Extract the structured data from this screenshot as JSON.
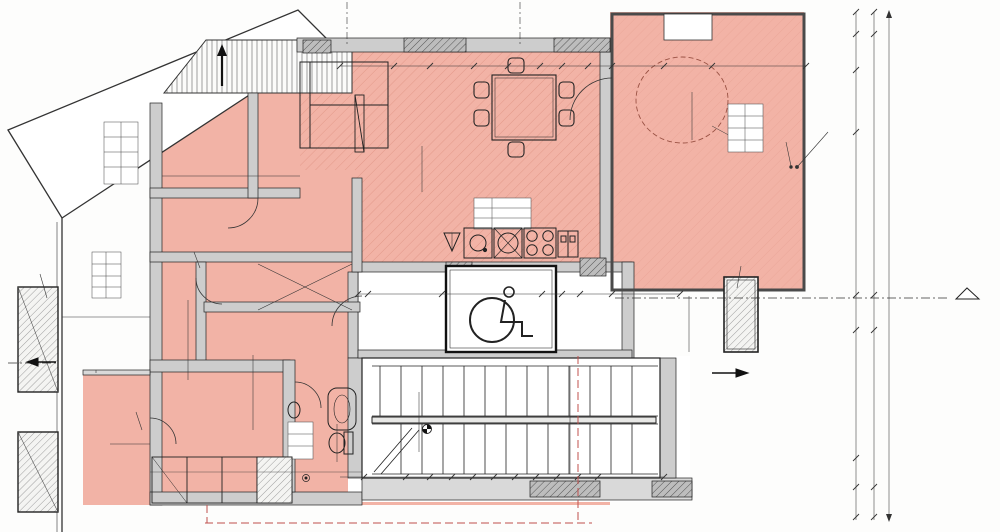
{
  "drawing": {
    "type": "architectural floor plan (attic storey)",
    "language": "Bulgarian",
    "colors": {
      "floor": "#f2b3a6",
      "wall": "#cdcdcd",
      "line": "#222222",
      "red_line": "#c0504d"
    }
  },
  "labels": [
    {
      "name": "dim-label",
      "t": "ВГ 9",
      "x": 190,
      "y": 20,
      "s": 4.5
    },
    {
      "name": "dim-label",
      "t": "ВГ 10 15",
      "x": 466,
      "y": 24,
      "s": 4.5
    },
    {
      "name": "opening-size",
      "t": "140/200",
      "x": 357,
      "y": 28,
      "r": -90,
      "s": 4.5
    },
    {
      "name": "opening-size",
      "t": "140/200",
      "x": 530,
      "y": 28,
      "r": -90,
      "s": 4.5
    },
    {
      "name": "angle-label",
      "t": "45°",
      "x": 489,
      "y": 13,
      "r": -90,
      "s": 5
    },
    {
      "name": "dim-label",
      "t": "210",
      "x": 240,
      "y": 57,
      "s": 6
    },
    {
      "name": "dim-label",
      "t": "274.5",
      "x": 254,
      "y": 80,
      "s": 6
    },
    {
      "name": "dim-label",
      "t": "100",
      "x": 205,
      "y": 90,
      "s": 5
    },
    {
      "name": "dim-label",
      "t": "154",
      "x": 247,
      "y": 91,
      "s": 5
    },
    {
      "name": "dim-label",
      "t": "25",
      "x": 296,
      "y": 66,
      "s": 4.5
    },
    {
      "name": "dim-label",
      "t": "10.5",
      "x": 312,
      "y": 81,
      "s": 4.5
    },
    {
      "name": "dim-label",
      "t": "210",
      "x": 367,
      "y": 63,
      "s": 6
    },
    {
      "name": "dim-label",
      "t": "133",
      "x": 452,
      "y": 66,
      "s": 6
    },
    {
      "name": "dim-label",
      "t": "140",
      "x": 523,
      "y": 66,
      "s": 6,
      "bg": "#ffffff"
    },
    {
      "name": "dim-label",
      "t": "78",
      "x": 574,
      "y": 68,
      "s": 6
    },
    {
      "name": "dim-label",
      "t": "10",
      "x": 617,
      "y": 61,
      "s": 4.5
    },
    {
      "name": "dim-label",
      "t": "193",
      "x": 639,
      "y": 67,
      "s": 6
    },
    {
      "name": "dim-label",
      "t": "194",
      "x": 757,
      "y": 67,
      "s": 6
    },
    {
      "name": "building-line-label",
      "t": "ЛИНИЯ НА ЗАСТРОЯВАНЕ",
      "x": 537,
      "y": 159,
      "s": 4.3,
      "c": "#c0504d",
      "bg": "#fdf0ec"
    },
    {
      "name": "dim-label",
      "t": "#150",
      "x": 686,
      "y": 88,
      "r": -35,
      "s": 5.5,
      "c": "#8a4a3a"
    },
    {
      "name": "dim-label",
      "t": "347",
      "x": 693,
      "y": 116,
      "r": -78,
      "s": 5.5
    },
    {
      "name": "note",
      "t": "Архитектурен елемент \"А\" съгласно\nчл. 93, ал. 2 от НПНОИВТ - 7.06 м2",
      "x": 836,
      "y": 103,
      "r": -90,
      "s": 4.4
    },
    {
      "name": "note",
      "t": "Ажурен парапет\nН = 1.05м\nот горна под",
      "x": 786,
      "y": 116,
      "r": -90,
      "s": 4.4
    },
    {
      "name": "dim-label",
      "t": "61",
      "x": 856,
      "y": 23,
      "r": -90
    },
    {
      "name": "dim-label",
      "t": "58",
      "x": 856,
      "y": 52,
      "r": -90
    },
    {
      "name": "dim-label",
      "t": "154",
      "x": 856,
      "y": 101,
      "r": -90
    },
    {
      "name": "dim-label",
      "t": "277",
      "x": 856,
      "y": 211,
      "r": -90
    },
    {
      "name": "dim-label",
      "t": "135",
      "x": 856,
      "y": 312,
      "r": -90
    },
    {
      "name": "dim-label",
      "t": "188",
      "x": 856,
      "y": 392,
      "r": -90
    },
    {
      "name": "dim-label",
      "t": "132",
      "x": 856,
      "y": 473,
      "r": -90
    },
    {
      "name": "dim-label",
      "t": "28",
      "x": 856,
      "y": 512,
      "r": -90
    },
    {
      "name": "dim-label",
      "t": "61",
      "x": 874,
      "y": 20,
      "r": -90
    },
    {
      "name": "dim-label",
      "t": "489",
      "x": 874,
      "y": 158,
      "r": -90
    },
    {
      "name": "dim-label",
      "t": "135",
      "x": 874,
      "y": 310,
      "r": -90
    },
    {
      "name": "dim-label",
      "t": "320",
      "x": 874,
      "y": 430,
      "r": -90
    },
    {
      "name": "dim-label",
      "t": "28",
      "x": 874,
      "y": 513,
      "r": -90
    },
    {
      "name": "dim-label",
      "t": "1033",
      "x": 890,
      "y": 264,
      "r": -90
    },
    {
      "name": "section-letter",
      "t": "Г",
      "x": 967,
      "y": 309,
      "s": 9
    },
    {
      "name": "window-label",
      "t": "Velux VIU",
      "x": 741,
      "y": 251,
      "r": -75,
      "s": 4.4
    },
    {
      "name": "dim-label",
      "t": "449",
      "x": 689,
      "y": 322,
      "r": -90
    },
    {
      "name": "note",
      "t": "Архитектурен елемент \"Б\" съгласно\nчл. 93, ал. 2 от НПНОИВТ - 13.00 м2",
      "x": 701,
      "y": 228,
      "r": -90,
      "s": 4.4
    },
    {
      "name": "dim-label",
      "t": "193",
      "x": 655,
      "y": 294,
      "s": 6
    },
    {
      "name": "dim-label",
      "t": "112",
      "x": 571,
      "y": 294,
      "s": 6
    },
    {
      "name": "dim-label",
      "t": "190",
      "x": 505,
      "y": 292,
      "s": 6
    },
    {
      "name": "dim-label",
      "t": "150",
      "x": 405,
      "y": 294,
      "s": 6
    },
    {
      "name": "dim-label",
      "t": "25",
      "x": 363,
      "y": 293,
      "s": 4.5
    },
    {
      "name": "dim-label",
      "t": "10",
      "x": 561,
      "y": 286,
      "s": 4.2
    },
    {
      "name": "dim-label",
      "t": "135",
      "x": 589,
      "y": 311,
      "r": -90,
      "s": 5
    },
    {
      "name": "opening-size",
      "t": "100/210",
      "x": 367,
      "y": 307,
      "s": 4.2
    },
    {
      "name": "dim-label",
      "t": "460",
      "x": 478,
      "y": 192,
      "s": 5.5
    },
    {
      "name": "dim-label",
      "t": "585",
      "x": 447,
      "y": 177,
      "s": 5.5
    },
    {
      "name": "dim-label",
      "t": "434",
      "x": 422,
      "y": 168,
      "r": -90,
      "s": 5.5
    },
    {
      "name": "height-label",
      "t": "Н на 2.30м",
      "x": 588,
      "y": 207,
      "r": -90,
      "s": 4.2
    },
    {
      "name": "window-label",
      "t": "Velux VIU",
      "x": 194,
      "y": 238,
      "r": -90,
      "s": 4.2
    },
    {
      "name": "opening-size",
      "t": "80/140",
      "x": 142,
      "y": 197,
      "s": 4.5
    },
    {
      "name": "dim-label",
      "t": "27",
      "x": 289,
      "y": 191,
      "s": 5
    },
    {
      "name": "opening-size",
      "t": "80/210",
      "x": 295,
      "y": 224,
      "s": 4.2
    },
    {
      "name": "dim-label",
      "t": "222",
      "x": 224,
      "y": 192,
      "s": 5.5
    },
    {
      "name": "dim-label",
      "t": "249.5",
      "x": 231,
      "y": 176,
      "s": 5.5
    },
    {
      "name": "dim-label",
      "t": "248",
      "x": 188,
      "y": 339,
      "r": -90,
      "s": 5.5
    },
    {
      "name": "dim-label",
      "t": "222",
      "x": 233,
      "y": 332,
      "s": 5.5
    },
    {
      "name": "dim-label",
      "t": "140",
      "x": 115,
      "y": 317,
      "s": 5.5
    },
    {
      "name": "dim-label",
      "t": "10",
      "x": 143,
      "y": 312,
      "s": 4.2
    },
    {
      "name": "opening-size",
      "t": "180/140",
      "x": 137,
      "y": 444,
      "s": 4.2
    },
    {
      "name": "dim-label",
      "t": "10",
      "x": 146,
      "y": 471,
      "s": 4.2
    },
    {
      "name": "dim-label",
      "t": "222",
      "x": 221,
      "y": 472,
      "s": 5.5
    },
    {
      "name": "dim-label",
      "t": "436",
      "x": 253,
      "y": 392,
      "r": -90,
      "s": 5.5
    },
    {
      "name": "dim-label",
      "t": "219",
      "x": 258,
      "y": 429,
      "r": -90,
      "s": 5
    },
    {
      "name": "note",
      "t": "Ажурен парапет\nН = 1.05м\nот горна под",
      "x": 96,
      "y": 392,
      "r": -90,
      "s": 4.4
    },
    {
      "name": "angle-label",
      "t": "45°",
      "x": 62,
      "y": 356,
      "s": 5.5
    },
    {
      "name": "angle-label",
      "t": "45°",
      "x": 729,
      "y": 366,
      "s": 5.5
    },
    {
      "name": "window-label",
      "t": "Velux VIU",
      "x": 40,
      "y": 257,
      "r": -90,
      "s": 4.2
    },
    {
      "name": "window-label",
      "t": "Velux VIU",
      "x": 136,
      "y": 396,
      "r": -90,
      "s": 4.2
    },
    {
      "name": "opening-size",
      "t": "80/210",
      "x": 311,
      "y": 367,
      "s": 4.2
    },
    {
      "name": "dim-label",
      "t": "260",
      "x": 337,
      "y": 442,
      "r": -90,
      "s": 5.5
    },
    {
      "name": "dim-label",
      "t": "140",
      "x": 322,
      "y": 474,
      "s": 5.5
    },
    {
      "name": "stair-note",
      "t": "17ст. - 16.47 / 30 см",
      "x": 511,
      "y": 407,
      "s": 7.5
    },
    {
      "name": "level-label",
      "t": "+17.00",
      "x": 430,
      "y": 452,
      "r": -90,
      "s": 6,
      "b": true
    },
    {
      "name": "level-label",
      "t": "174.80",
      "x": 440,
      "y": 455,
      "r": -90,
      "s": 6
    },
    {
      "name": "dim-label",
      "t": "250",
      "x": 419,
      "y": 422,
      "r": -90,
      "s": 5.5
    },
    {
      "name": "dim-label",
      "t": "120",
      "x": 570,
      "y": 389,
      "r": -90,
      "s": 5.5
    },
    {
      "name": "dim-label",
      "t": "120",
      "x": 570,
      "y": 453,
      "r": -90,
      "s": 5.5
    },
    {
      "name": "dim-label",
      "t": "25",
      "x": 352,
      "y": 475,
      "s": 4.2
    },
    {
      "name": "dim-label",
      "t": "70",
      "x": 388,
      "y": 476,
      "s": 5.5
    },
    {
      "name": "dim-label",
      "t": "50",
      "x": 418,
      "y": 476,
      "s": 5.5
    },
    {
      "name": "dim-label",
      "t": "45",
      "x": 442,
      "y": 477,
      "s": 5.5
    },
    {
      "name": "dim-label",
      "t": "30",
      "x": 462,
      "y": 478,
      "s": 4.3
    },
    {
      "name": "dim-label",
      "t": "30",
      "x": 483,
      "y": 478,
      "s": 4.3
    },
    {
      "name": "dim-label",
      "t": "30",
      "x": 504,
      "y": 478,
      "s": 4.3
    },
    {
      "name": "dim-label",
      "t": "30",
      "x": 525,
      "y": 478,
      "s": 4.3
    },
    {
      "name": "dim-label",
      "t": "30",
      "x": 546,
      "y": 478,
      "s": 4.3
    },
    {
      "name": "dim-label",
      "t": "30",
      "x": 567,
      "y": 478,
      "s": 4.3
    },
    {
      "name": "dim-label",
      "t": "30",
      "x": 587,
      "y": 478,
      "s": 4.3
    },
    {
      "name": "dim-label",
      "t": "120",
      "x": 650,
      "y": 475,
      "s": 5.5
    },
    {
      "name": "opening-size",
      "t": "90/200",
      "x": 654,
      "y": 469,
      "s": 4.2
    },
    {
      "name": "dim-label",
      "t": "10",
      "x": 568,
      "y": 509,
      "r": -90,
      "s": 4.2
    },
    {
      "name": "building-line-label",
      "t": "линия на застрояване",
      "x": 573,
      "y": 420,
      "r": -90,
      "s": 3.8,
      "c": "#c0504d"
    },
    {
      "name": "opening-size",
      "t": "160/200",
      "x": 622,
      "y": 98,
      "s": 4.2
    },
    {
      "name": "dim-label",
      "t": "ПТ 9",
      "x": 611,
      "y": 447,
      "r": -90,
      "s": 3.8
    },
    {
      "name": "opening-mark",
      "t": "П1",
      "x": 347,
      "y": 7,
      "s": 4.2,
      "circ": 12
    },
    {
      "name": "opening-mark",
      "t": "П1",
      "x": 520,
      "y": 6,
      "s": 4.2,
      "circ": 12
    },
    {
      "name": "opening-mark",
      "t": "Э",
      "x": 117,
      "y": 198,
      "s": 4.2,
      "circ": 10
    },
    {
      "name": "opening-mark",
      "t": "В",
      "x": 310,
      "y": 225,
      "s": 4,
      "circ": 9
    },
    {
      "name": "opening-mark",
      "t": "1В",
      "x": 385,
      "y": 308,
      "s": 4,
      "circ": 10
    },
    {
      "name": "opening-mark",
      "t": "П1",
      "x": 118,
      "y": 444,
      "s": 4,
      "circ": 10
    },
    {
      "name": "opening-mark",
      "t": "В",
      "x": 292,
      "y": 364,
      "s": 4,
      "circ": 9
    },
    {
      "name": "opening-mark",
      "t": "П1",
      "x": 672,
      "y": 469,
      "s": 4.2,
      "circ": 12
    },
    {
      "name": "opening-mark",
      "t": "Э",
      "x": 636,
      "y": 98,
      "s": 4,
      "circ": 9
    }
  ]
}
